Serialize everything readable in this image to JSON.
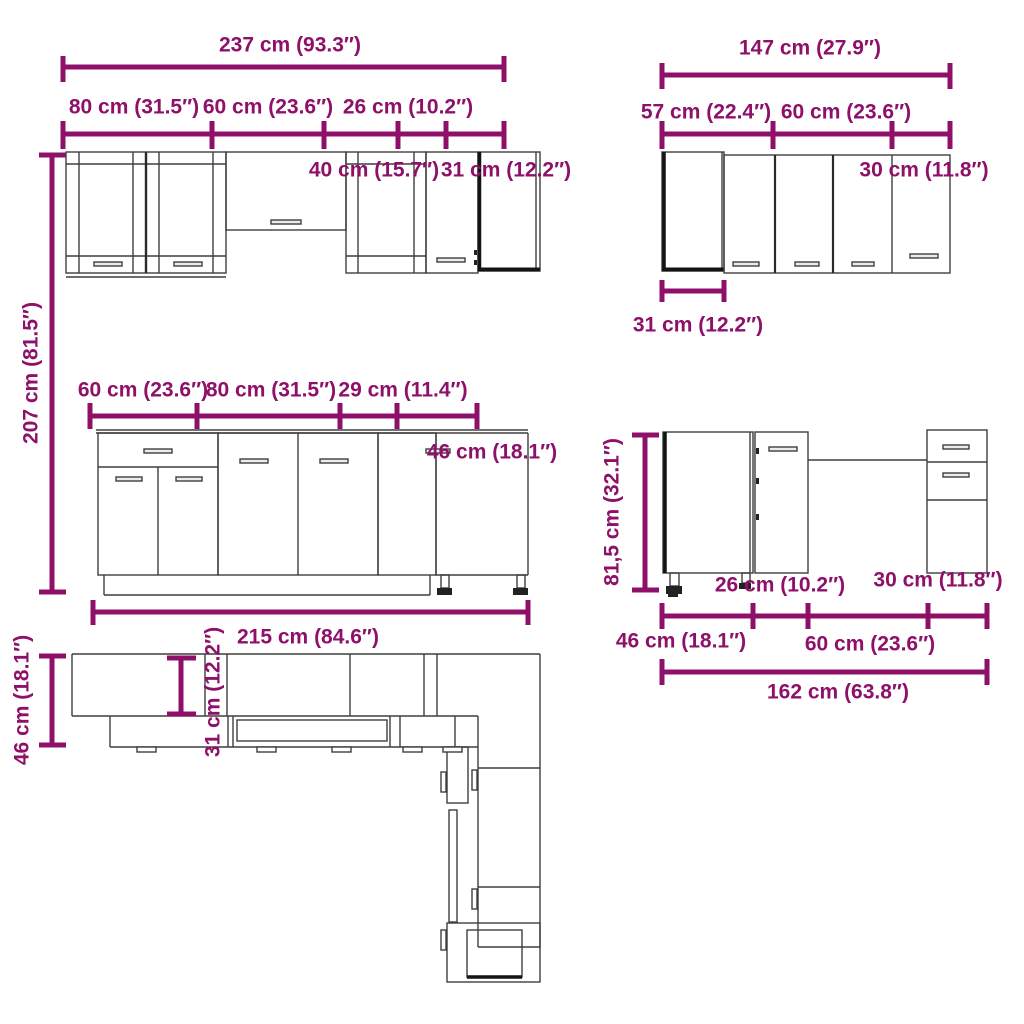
{
  "document": {
    "type": "kitchen-cabinet-set-dimension-diagram",
    "background": "#FFFFFF"
  },
  "colors": {
    "dimension_accent": "#8E1069",
    "drawing_outline": "#3E3E3E",
    "dark_edge": "#141414"
  },
  "views": {
    "wall_top_left": {
      "name": "wall-cabinet-run-front-view-left",
      "total_width": "237 cm (93.3″)",
      "segments": [
        "80 cm (31.5″)",
        "60 cm (23.6″)",
        "40 cm (15.7″)",
        "26 cm (10.2″)",
        "31 cm (12.2″)"
      ],
      "height": "207 cm (81.5″)"
    },
    "wall_top_right": {
      "name": "wall-cabinet-run-front-view-right",
      "total_width": "147 cm (27.9″)",
      "segments": [
        "57 cm (22.4″)",
        "60 cm (23.6″)",
        "30 cm (11.8″)"
      ],
      "corner_depth": "31 cm (12.2″)"
    },
    "base_left": {
      "name": "base-cabinet-run-front-view-left",
      "segments": [
        "60 cm (23.6″)",
        "80 cm (31.5″)",
        "29 cm (11.4″)",
        "46 cm (18.1″)"
      ],
      "total_width": "215 cm (84.6″)"
    },
    "base_right": {
      "name": "base-cabinet-run-front-view-right",
      "height": "81,5 cm (32.1″)",
      "segments": [
        "46 cm (18.1″)",
        "26 cm (10.2″)",
        "60 cm (23.6″)",
        "30 cm (11.8″)"
      ],
      "total_width": "162 cm (63.8″)"
    },
    "floor_plan": {
      "name": "l-shaped-floor-plan-top-view",
      "base_depth": "46 cm (18.1″)",
      "wall_depth": "31 cm (12.2″)"
    }
  }
}
